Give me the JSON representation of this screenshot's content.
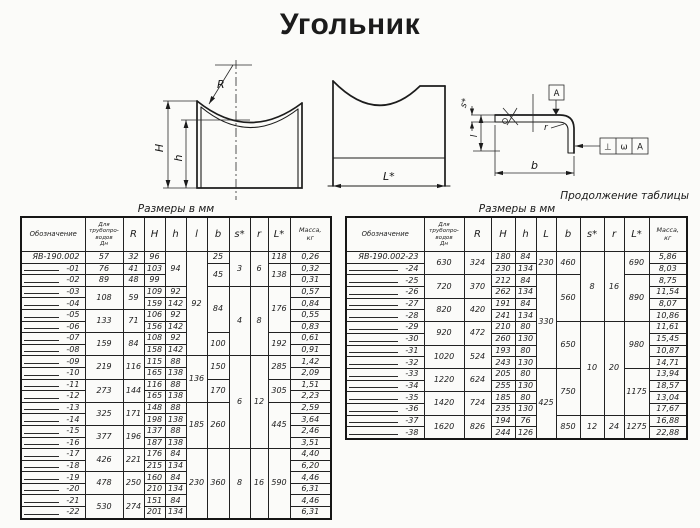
{
  "title": "Угольник",
  "drawing_labels": {
    "radius": "R",
    "height_outer": "H",
    "height_inner": "h",
    "length": "L*",
    "thickness": "s*",
    "leg": "l",
    "width": "b",
    "corner_radius": "r",
    "datum": "А",
    "fcf_symbol": "⊥",
    "fcf_value": "ω",
    "fcf_datum": "А"
  },
  "left_table": {
    "caption": "Размеры в мм",
    "headers": [
      "Обозначение",
      "Для трубопро-\nводов\nДн",
      "R",
      "H",
      "h",
      "l",
      "b",
      "s*",
      "r",
      "L*",
      "Масса,\nкг"
    ],
    "rows": [
      [
        "ЯВ-190.002",
        "57",
        "32",
        "96",
        {
          "t": "94",
          "rs": 3
        },
        {
          "t": "92",
          "rs": 9
        },
        "25",
        {
          "t": "3",
          "rs": 3
        },
        {
          "t": "6",
          "rs": 3
        },
        "118",
        "0,26"
      ],
      [
        "-01",
        "76",
        "41",
        "103",
        null,
        null,
        {
          "t": "45",
          "rs": 2
        },
        null,
        null,
        {
          "t": "138",
          "rs": 2
        },
        "0,32"
      ],
      [
        "-02",
        "89",
        "48",
        "99",
        null,
        null,
        null,
        null,
        null,
        null,
        "0,31"
      ],
      [
        "-03",
        {
          "t": "108",
          "rs": 2
        },
        {
          "t": "59",
          "rs": 2
        },
        "109",
        "92",
        null,
        {
          "t": "84",
          "rs": 4
        },
        {
          "t": "4",
          "rs": 6
        },
        {
          "t": "8",
          "rs": 6
        },
        {
          "t": "176",
          "rs": 4
        },
        "0,57"
      ],
      [
        "-04",
        null,
        null,
        "159",
        "142",
        null,
        null,
        null,
        null,
        null,
        "0,84"
      ],
      [
        "-05",
        {
          "t": "133",
          "rs": 2
        },
        {
          "t": "71",
          "rs": 2
        },
        "106",
        "92",
        null,
        null,
        null,
        null,
        null,
        "0,55"
      ],
      [
        "-06",
        null,
        null,
        "156",
        "142",
        null,
        null,
        null,
        null,
        null,
        "0,83"
      ],
      [
        "-07",
        {
          "t": "159",
          "rs": 2
        },
        {
          "t": "84",
          "rs": 2
        },
        "108",
        "92",
        null,
        {
          "t": "100",
          "rs": 2
        },
        null,
        null,
        {
          "t": "192",
          "rs": 2
        },
        "0,61"
      ],
      [
        "-08",
        null,
        null,
        "158",
        "142",
        null,
        null,
        null,
        null,
        null,
        "0,91"
      ],
      [
        "-09",
        {
          "t": "219",
          "rs": 2
        },
        {
          "t": "116",
          "rs": 2
        },
        "115",
        "88",
        {
          "t": "136",
          "rs": 4
        },
        {
          "t": "150",
          "rs": 2
        },
        {
          "t": "6",
          "rs": 8
        },
        {
          "t": "12",
          "rs": 8
        },
        {
          "t": "285",
          "rs": 2
        },
        "1,42"
      ],
      [
        "-10",
        null,
        null,
        "165",
        "138",
        null,
        null,
        null,
        null,
        null,
        "2,09"
      ],
      [
        "-11",
        {
          "t": "273",
          "rs": 2
        },
        {
          "t": "144",
          "rs": 2
        },
        "116",
        "88",
        null,
        {
          "t": "170",
          "rs": 2
        },
        null,
        null,
        {
          "t": "305",
          "rs": 2
        },
        "1,51"
      ],
      [
        "-12",
        null,
        null,
        "165",
        "138",
        null,
        null,
        null,
        null,
        null,
        "2,23"
      ],
      [
        "-13",
        {
          "t": "325",
          "rs": 2
        },
        {
          "t": "171",
          "rs": 2
        },
        "148",
        "88",
        {
          "t": "185",
          "rs": 4
        },
        {
          "t": "260",
          "rs": 4
        },
        null,
        null,
        {
          "t": "445",
          "rs": 4
        },
        "2,59"
      ],
      [
        "-14",
        null,
        null,
        "198",
        "138",
        null,
        null,
        null,
        null,
        null,
        "3,64"
      ],
      [
        "-15",
        {
          "t": "377",
          "rs": 2
        },
        {
          "t": "196",
          "rs": 2
        },
        "137",
        "88",
        null,
        null,
        null,
        null,
        null,
        "2,46"
      ],
      [
        "-16",
        null,
        null,
        "187",
        "138",
        null,
        null,
        null,
        null,
        null,
        "3,51"
      ],
      [
        "-17",
        {
          "t": "426",
          "rs": 2
        },
        {
          "t": "221",
          "rs": 2
        },
        "176",
        "84",
        {
          "t": "230",
          "rs": 6
        },
        {
          "t": "360",
          "rs": 6
        },
        {
          "t": "8",
          "rs": 6
        },
        {
          "t": "16",
          "rs": 6
        },
        {
          "t": "590",
          "rs": 6
        },
        "4,40"
      ],
      [
        "-18",
        null,
        null,
        "215",
        "134",
        null,
        null,
        null,
        null,
        null,
        "6,20"
      ],
      [
        "-19",
        {
          "t": "478",
          "rs": 2
        },
        {
          "t": "250",
          "rs": 2
        },
        "160",
        "84",
        null,
        null,
        null,
        null,
        null,
        "4,46"
      ],
      [
        "-20",
        null,
        null,
        "210",
        "134",
        null,
        null,
        null,
        null,
        null,
        "6,31"
      ],
      [
        "-21",
        {
          "t": "530",
          "rs": 2
        },
        {
          "t": "274",
          "rs": 2
        },
        "151",
        "84",
        null,
        null,
        null,
        null,
        null,
        "4,46"
      ],
      [
        "-22",
        null,
        null,
        "201",
        "134",
        null,
        null,
        null,
        null,
        null,
        "6,31"
      ]
    ]
  },
  "right_table": {
    "continuation": "Продолжение таблицы",
    "caption": "Размеры в мм",
    "headers": [
      "Обозначение",
      "Для трубопро-\nводов\nДн",
      "R",
      "H",
      "h",
      "L",
      "b",
      "s*",
      "r",
      "L*",
      "Масса,\nкг"
    ],
    "rows": [
      [
        "ЯВ-190.002-23",
        {
          "t": "630",
          "rs": 2
        },
        {
          "t": "324",
          "rs": 2
        },
        "180",
        "84",
        {
          "t": "230",
          "rs": 2
        },
        {
          "t": "460",
          "rs": 2
        },
        {
          "t": "8",
          "rs": 6
        },
        {
          "t": "16",
          "rs": 6
        },
        {
          "t": "690",
          "rs": 2
        },
        "5,86"
      ],
      [
        "-24",
        null,
        null,
        "230",
        "134",
        null,
        null,
        null,
        null,
        null,
        "8,03"
      ],
      [
        "-25",
        {
          "t": "720",
          "rs": 2
        },
        {
          "t": "370",
          "rs": 2
        },
        "212",
        "84",
        {
          "t": "330",
          "rs": 8
        },
        {
          "t": "560",
          "rs": 4
        },
        null,
        null,
        {
          "t": "890",
          "rs": 4
        },
        "8,75"
      ],
      [
        "-26",
        null,
        null,
        "262",
        "134",
        null,
        null,
        null,
        null,
        null,
        "11,54"
      ],
      [
        "-27",
        {
          "t": "820",
          "rs": 2
        },
        {
          "t": "420",
          "rs": 2
        },
        "191",
        "84",
        null,
        null,
        null,
        null,
        null,
        "8,07"
      ],
      [
        "-28",
        null,
        null,
        "241",
        "134",
        null,
        null,
        null,
        null,
        null,
        "10,86"
      ],
      [
        "-29",
        {
          "t": "920",
          "rs": 2
        },
        {
          "t": "472",
          "rs": 2
        },
        "210",
        "80",
        null,
        {
          "t": "650",
          "rs": 4
        },
        {
          "t": "10",
          "rs": 8
        },
        {
          "t": "20",
          "rs": 8
        },
        {
          "t": "980",
          "rs": 4
        },
        "11,61"
      ],
      [
        "-30",
        null,
        null,
        "260",
        "130",
        null,
        null,
        null,
        null,
        null,
        "15,45"
      ],
      [
        "-31",
        {
          "t": "1020",
          "rs": 2
        },
        {
          "t": "524",
          "rs": 2
        },
        "193",
        "80",
        null,
        null,
        null,
        null,
        null,
        "10,87"
      ],
      [
        "-32",
        null,
        null,
        "243",
        "130",
        null,
        null,
        null,
        null,
        null,
        "14,71"
      ],
      [
        "-33",
        {
          "t": "1220",
          "rs": 2
        },
        {
          "t": "624",
          "rs": 2
        },
        "205",
        "80",
        {
          "t": "425",
          "rs": 6
        },
        {
          "t": "750",
          "rs": 4
        },
        null,
        null,
        {
          "t": "1175",
          "rs": 4
        },
        "13,94"
      ],
      [
        "-34",
        null,
        null,
        "255",
        "130",
        null,
        null,
        null,
        null,
        null,
        "18,57"
      ],
      [
        "-35",
        {
          "t": "1420",
          "rs": 2
        },
        {
          "t": "724",
          "rs": 2
        },
        "185",
        "80",
        null,
        null,
        null,
        null,
        null,
        "13,04"
      ],
      [
        "-36",
        null,
        null,
        "235",
        "130",
        null,
        null,
        null,
        null,
        null,
        "17,67"
      ],
      [
        "-37",
        {
          "t": "1620",
          "rs": 2
        },
        {
          "t": "826",
          "rs": 2
        },
        "194",
        "76",
        null,
        {
          "t": "850",
          "rs": 2
        },
        {
          "t": "12",
          "rs": 2
        },
        {
          "t": "24",
          "rs": 2
        },
        {
          "t": "1275",
          "rs": 2
        },
        "16,88"
      ],
      [
        "-38",
        null,
        null,
        "244",
        "126",
        null,
        null,
        null,
        null,
        null,
        "22,88"
      ]
    ]
  }
}
